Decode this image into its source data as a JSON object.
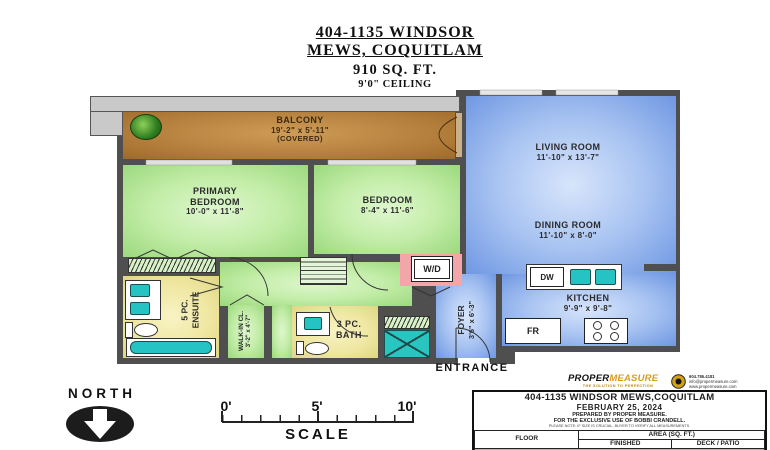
{
  "header": {
    "address_line1": "404-1135 WINDSOR",
    "address_line2": "MEWS, COQUITLAM",
    "area": "910 SQ. FT.",
    "ceiling": "9'0\" CEILING"
  },
  "rooms": {
    "balcony": {
      "name": "BALCONY",
      "dims": "19'-2\" x 5'-11\"",
      "note": "(COVERED)"
    },
    "living_room": {
      "name": "LIVING ROOM",
      "dims": "11'-10\" x 13'-7\""
    },
    "dining_room": {
      "name": "DINING ROOM",
      "dims": "11'-10\" x 8'-0\""
    },
    "primary_bedroom": {
      "name1": "PRIMARY",
      "name2": "BEDROOM",
      "dims": "10'-0\" x 11'-8\""
    },
    "bedroom": {
      "name": "BEDROOM",
      "dims": "8'-4\" x 11'-6\""
    },
    "kitchen": {
      "name": "KITCHEN",
      "dims": "9'-9\" x 9'-8\""
    },
    "ensuite": {
      "line1": "5 PC.",
      "line2": "ENSUITE"
    },
    "bath": {
      "line1": "3 PC.",
      "line2": "BATH"
    },
    "walk_in_closet": {
      "line1": "WALK-IN CL.",
      "line2": "3'-2\" x 4'-7\""
    },
    "foyer": {
      "line1": "FOYER",
      "line2": "3'6\" x 6'-3\""
    }
  },
  "appliances": {
    "washer_dryer": "W/D",
    "dishwasher": "DW",
    "fridge": "FR"
  },
  "entrance_label": "ENTRANCE",
  "compass_label": "NORTH",
  "scale": {
    "tick0": "0'",
    "tick5": "5'",
    "tick10": "10'",
    "label": "SCALE"
  },
  "footer": {
    "logo_text1": "PROPER",
    "logo_text2": "MEASURE",
    "logo_tagline": "THE SOLUTION TO PERFECTION",
    "contact_line1": "604.786.4181",
    "contact_line2": "info@propermeasure.com",
    "contact_line3": "www.propermeasure.com",
    "box_title": "404-1135 WINDSOR MEWS,COQUITLAM",
    "box_date": "FEBRUARY 25, 2024",
    "box_line1": "PREPARED BY PROPER MEASURE.",
    "box_line2": "FOR THE EXCLUSIVE USE OF BOBBI CRANDELL.",
    "box_disclaimer": "PLEASE NOTE: IF SIZE IS CRUCIAL, BUYER TO VERIFY ALL MEASUREMENTS.",
    "table": {
      "col_floor": "FLOOR",
      "col_area": "AREA (SQ. FT.)",
      "col_finished": "FINISHED",
      "col_deck": "DECK / PATIO",
      "row": {
        "floor": "FOURTH",
        "finished": "910",
        "deck": "116"
      }
    }
  },
  "colors": {
    "balcony_brown": "#b07b38",
    "bedroom_green": "#b9e89c",
    "living_blue": "#7fa3e8",
    "bath_yellow": "#eee69f",
    "wd_pink": "#f2a6a9",
    "fixture_teal": "#25c3c3",
    "wall_gray": "#4f4f4f",
    "eave_gray": "#c9c9c9",
    "logo_gold": "#d4a017"
  }
}
